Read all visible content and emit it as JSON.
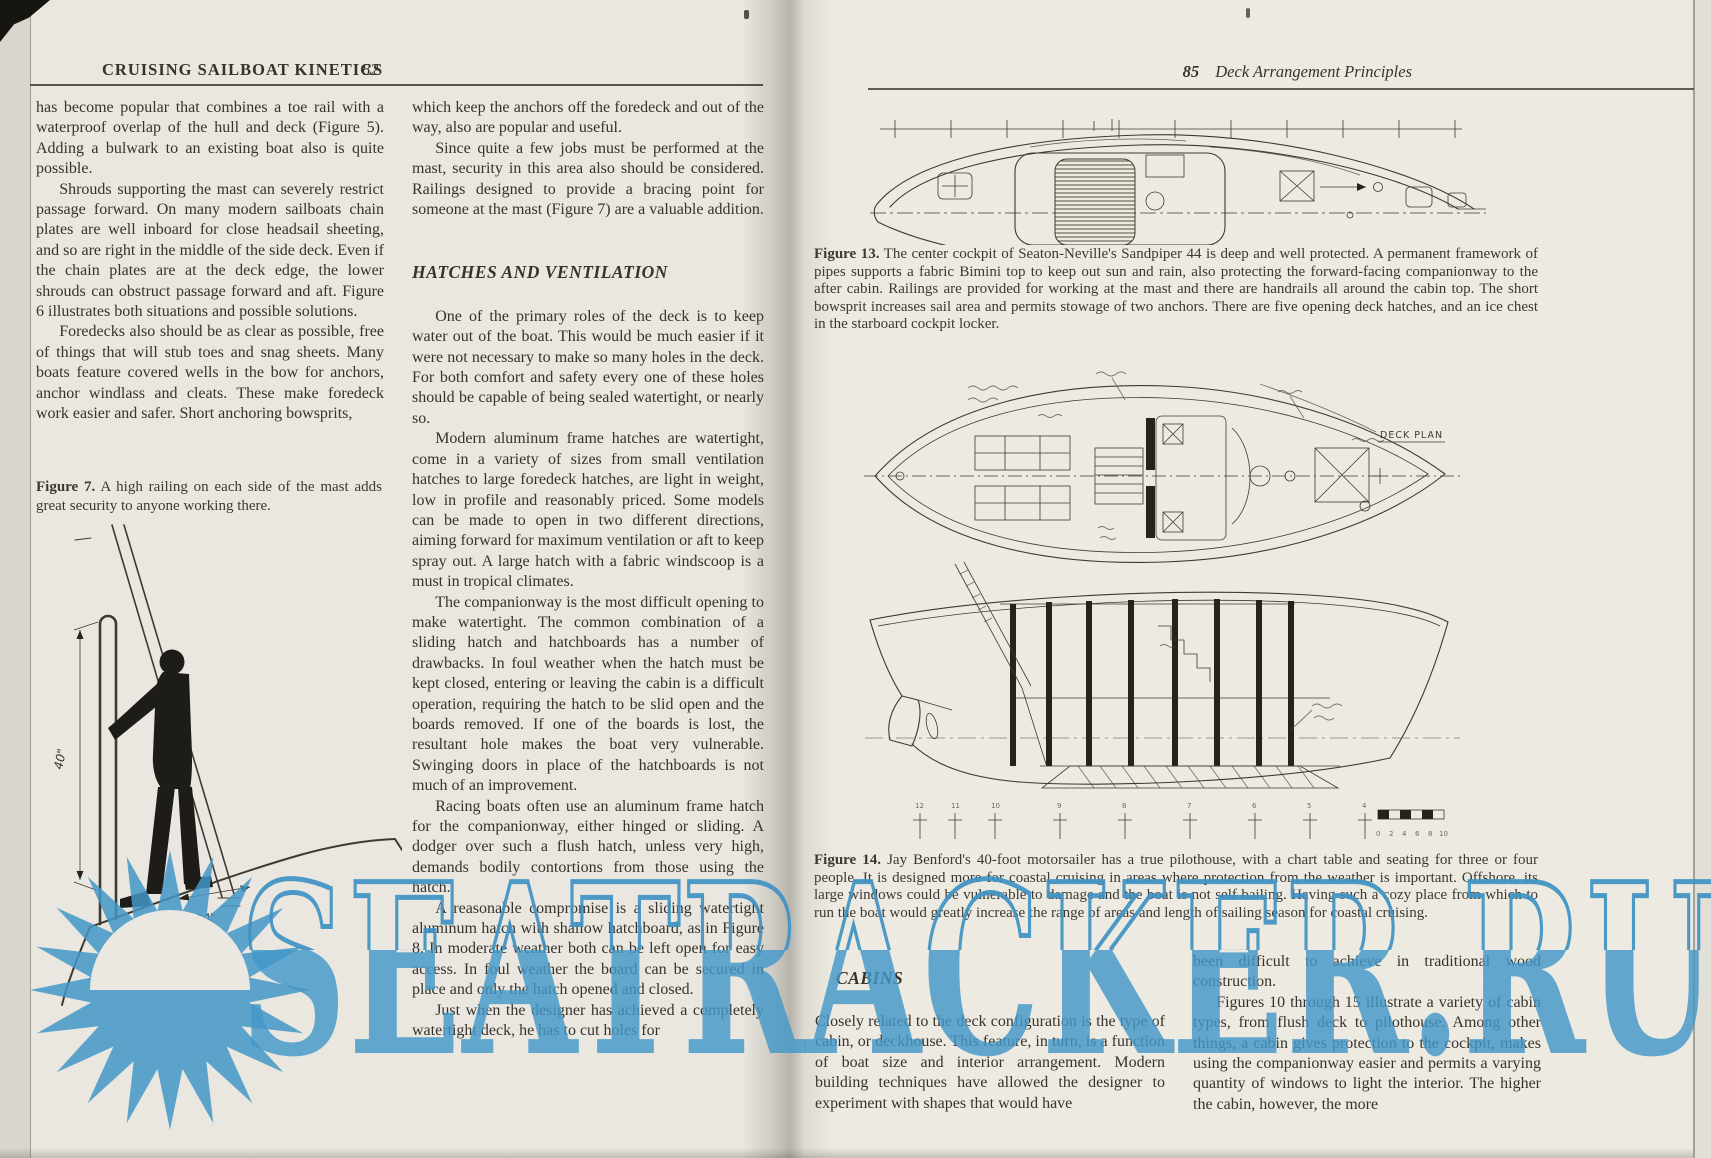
{
  "watermark": {
    "text": "SEATRACKER.RU",
    "color": "#4397c8"
  },
  "left_page": {
    "header": {
      "title": "CRUISING SAILBOAT KINETICS",
      "page_number": "82"
    },
    "column1": {
      "paragraphs": [
        "has become popular that combines a toe rail with a waterproof overlap of the hull and deck (Figure 5). Adding a bulwark to an existing boat also is quite possible.",
        "Shrouds supporting the mast can severely restrict passage forward. On many modern sailboats chain plates are well inboard for close headsail sheeting, and so are right in the middle of the side deck. Even if the chain plates are at the deck edge, the lower shrouds can obstruct passage forward and aft. Figure 6 illustrates both situations and possible solutions.",
        "Foredecks also should be as clear as possible, free of things that will stub toes and snag sheets. Many boats feature covered wells in the bow for anchors, anchor windlass and cleats. These make foredeck work easier and safer. Short anchoring bowsprits,"
      ]
    },
    "figure7": {
      "label": "Figure 7.",
      "caption": "A high railing on each side of the mast adds great security to anyone working there.",
      "dim_vertical": "40\"",
      "dim_horizontal": "24\""
    },
    "column2": {
      "paragraphs_top": [
        "which keep the anchors off the foredeck and out of the way, also are popular and useful.",
        "Since quite a few jobs must be performed at the mast, security in this area also should be considered. Railings designed to provide a bracing point for someone at the mast (Figure 7) are a valuable addition."
      ],
      "section_heading": "HATCHES AND VENTILATION",
      "paragraphs_bottom": [
        "One of the primary roles of the deck is to keep water out of the boat. This would be much easier if it were not necessary to make so many holes in the deck. For both comfort and safety every one of these holes should be capable of being sealed watertight, or nearly so.",
        "Modern aluminum frame hatches are watertight, come in a variety of sizes from small ventilation hatches to large foredeck hatches, are light in weight, low in profile and reasonably priced. Some models can be made to open in two different directions, aiming forward for maximum ventilation or aft to keep spray out. A large hatch with a fabric windscoop is a must in tropical climates.",
        "The companionway is the most difficult opening to make watertight. The common combination of a sliding hatch and hatchboards has a number of drawbacks. In foul weather when the hatch must be kept closed, entering or leaving the cabin is a difficult operation, requiring the hatch to be slid open and the boards removed. If one of the boards is lost, the resultant hole makes the boat very vulnerable. Swinging doors in place of the hatchboards is not much of an improvement.",
        "Racing boats often use an aluminum frame hatch for the companionway, either hinged or sliding. A dodger over such a flush hatch, unless very high, demands bodily contortions from those using the hatch.",
        "A reasonable compromise is a sliding watertight aluminum hatch with shallow hatchboard, as in Figure 8. In moderate weather both can be left open for easy access. In foul weather the board can be secured in place and only the hatch opened and closed.",
        "Just when the designer has achieved a completely watertight deck, he has to cut holes for"
      ]
    }
  },
  "right_page": {
    "header": {
      "page_number": "85",
      "title": "Deck Arrangement Principles"
    },
    "figure13": {
      "label": "Figure 13.",
      "caption": "The center cockpit of Seaton-Neville's Sandpiper 44 is deep and well protected. A permanent framework of pipes supports a fabric Bimini top to keep out sun and rain, also protecting the forward-facing companionway to the after cabin. Railings are provided for working at the mast and there are handrails all around the cabin top. The short bowsprit increases sail area and permits stowage of two anchors. There are five opening deck hatches, and an ice chest in the starboard cockpit locker."
    },
    "figure14": {
      "label": "Figure 14.",
      "caption": "Jay Benford's 40-foot motorsailer has a true pilothouse, with a chart table and seating for three or four people. It is designed more for coastal cruising in areas where protection from the weather is important. Offshore, its large windows could be vulnerable to damage and the boat is not self bailing. Having such a cozy place from which to run the boat would greatly increase the range of areas and length of sailing season for coastal cruising.",
      "deck_plan_label": "DECK PLAN",
      "station_numbers": [
        "12",
        "11",
        "10",
        "9",
        "8",
        "7",
        "6",
        "5",
        "4"
      ],
      "scale_numbers": [
        "0",
        "2",
        "4",
        "6",
        "8",
        "10"
      ]
    },
    "cabins": {
      "section_heading": "CABINS",
      "column1_paragraphs": [
        "Closely related to the deck configuration is the type of cabin, or deckhouse. This feature, in turn, is a function of boat size and interior arrangement. Modern building techniques have allowed the designer to experiment with shapes that would have"
      ],
      "column2_paragraphs": [
        "been difficult to achieve in traditional wood construction.",
        "Figures 10 through 15 illustrate a variety of cabin types, from flush deck to pilothouse. Among other things, a cabin gives protection to the cockpit, makes using the companionway easier and permits a varying quantity of windows to light the interior. The higher the cabin, however, the more"
      ]
    }
  }
}
